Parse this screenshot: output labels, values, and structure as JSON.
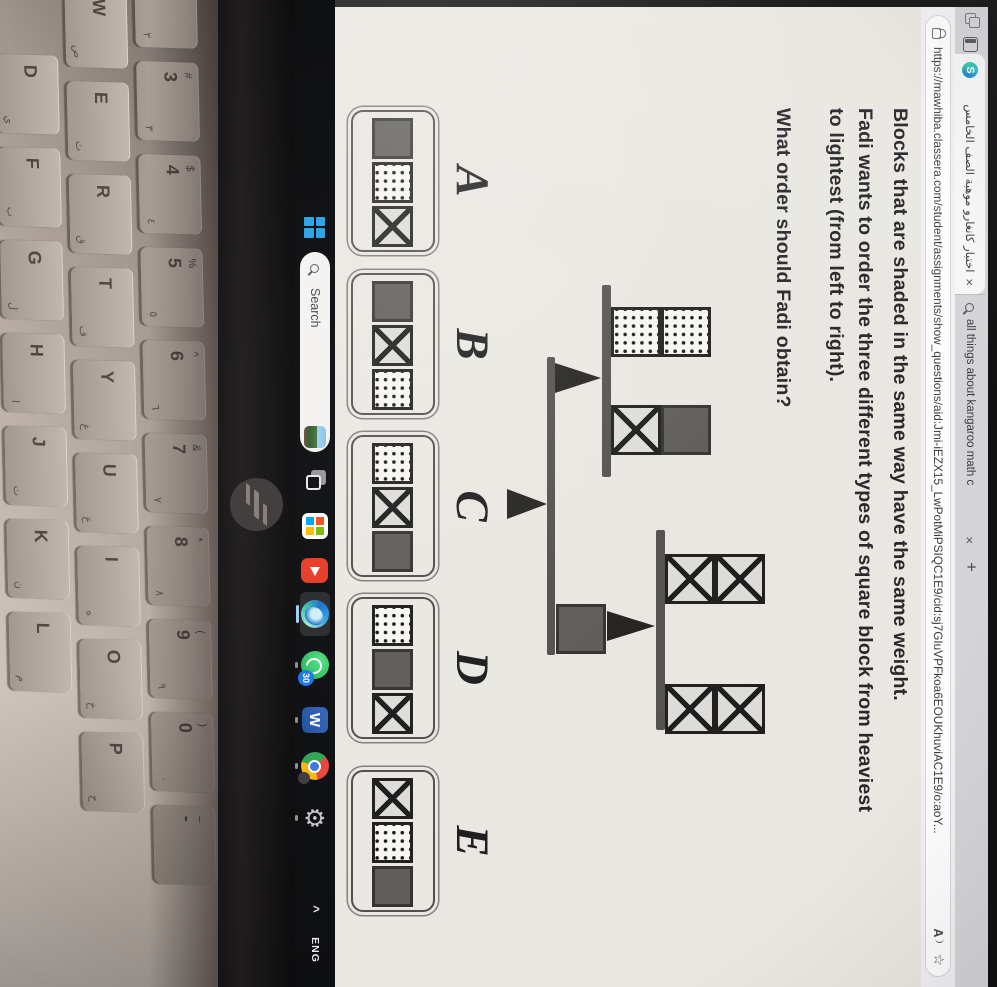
{
  "colors": {
    "page_bg": "#eae7e2",
    "chrome_strip": "#d4d3d7",
    "active_tab": "#f7f6f7",
    "taskbar_bg": "#0c0d10",
    "start_blue": "#2aa3e8",
    "block_gray": "#5e5c59",
    "youtube_red": "#e63b28",
    "whatsapp_green": "#1faf52",
    "edge_blue": "#1b6fd0"
  },
  "browser": {
    "tabs": [
      {
        "title": "اختبار كانغارو موهبة الصف الخامس",
        "close": "×"
      },
      {
        "title": "all things about kangaroo math c",
        "close": "×"
      }
    ],
    "new_tab": "+",
    "url": "https://mawhiba.classera.com/student/assignments/show_questions/aid:Jmi-iEZX15_LwPotMiPSIQC1E9/cid:sj7GIuVPFkoa6EOUKhuviAC1E9/o:aoY...",
    "read_aloud": "A",
    "favorite": "☆"
  },
  "question": {
    "line1": "Blocks that are shaded in the same way have the same weight.",
    "line2": "Fadi wants to order the three different types of square block from heaviest",
    "line3": "to lightest (from left to right).",
    "line4": "What order should Fadi obtain?"
  },
  "figure": {
    "description": "compound balance: main beam on central fulcrum; left sub-scale holds 2 dotted vs gray-on-x; right sub-scale (raised on a gray block) holds 2 x vs 2 x",
    "scale1": {
      "left": [
        "dotted",
        "dotted"
      ],
      "right": [
        "gray",
        "x"
      ]
    },
    "scale2": {
      "left": [
        "x",
        "x"
      ],
      "right": [
        "x",
        "x"
      ]
    },
    "base": [
      "gray"
    ]
  },
  "options": [
    {
      "letter": "A",
      "blocks": [
        "gray",
        "dotted",
        "x"
      ]
    },
    {
      "letter": "B",
      "blocks": [
        "gray",
        "x",
        "dotted"
      ]
    },
    {
      "letter": "C",
      "blocks": [
        "dotted",
        "x",
        "gray"
      ]
    },
    {
      "letter": "D",
      "blocks": [
        "dotted",
        "gray",
        "x"
      ]
    },
    {
      "letter": "E",
      "blocks": [
        "x",
        "dotted",
        "gray"
      ]
    }
  ],
  "taskbar": {
    "search_label": "Search",
    "whatsapp_badge": "30",
    "tray_chevron": "^",
    "language": "ENG"
  },
  "keyboard": {
    "rows": [
      {
        "keys": [
          [
            "2",
            "@",
            "٢"
          ],
          [
            "3",
            "#",
            "٣"
          ],
          [
            "4",
            "$",
            "٤"
          ],
          [
            "5",
            "%",
            "٥"
          ],
          [
            "6",
            "^",
            "٦"
          ],
          [
            "7",
            "&",
            "٧"
          ],
          [
            "8",
            "*",
            "٨"
          ],
          [
            "9",
            "(",
            "٩"
          ],
          [
            "0",
            ")",
            "٠"
          ],
          [
            "-",
            "_",
            ""
          ]
        ]
      },
      {
        "keys": [
          [
            "W",
            "",
            "ص"
          ],
          [
            "E",
            "",
            "ث"
          ],
          [
            "R",
            "",
            "ق"
          ],
          [
            "T",
            "",
            "ف"
          ],
          [
            "Y",
            "",
            "غ"
          ],
          [
            "U",
            "",
            "ع"
          ],
          [
            "I",
            "",
            "ه"
          ],
          [
            "O",
            "",
            "خ"
          ],
          [
            "P",
            "",
            "ح"
          ]
        ]
      },
      {
        "keys": [
          [
            "D",
            "",
            "ي"
          ],
          [
            "F",
            "",
            "ب"
          ],
          [
            "G",
            "",
            "ل"
          ],
          [
            "H",
            "",
            "ا"
          ],
          [
            "J",
            "",
            "ت"
          ],
          [
            "K",
            "",
            "ن"
          ],
          [
            "L",
            "",
            "م"
          ]
        ]
      }
    ]
  },
  "branding": {
    "laptop_logo": "hp"
  }
}
